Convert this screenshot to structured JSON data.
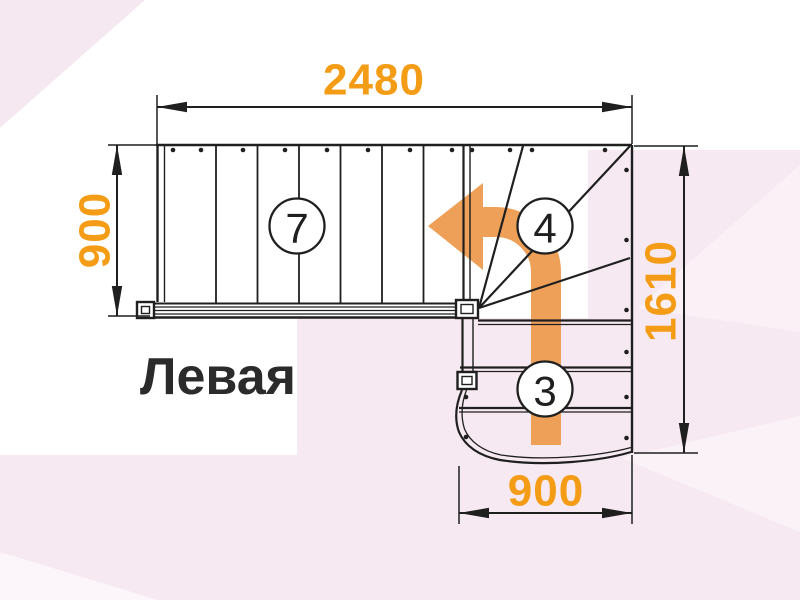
{
  "diagram": {
    "label": "Левая",
    "dimensions": {
      "top": "2480",
      "left": "900",
      "right": "1610",
      "bottom": "900"
    },
    "counts": {
      "main_flight": "7",
      "winder": "4",
      "lower_flight": "3"
    }
  },
  "colors": {
    "dimension_text": "#F49C15",
    "arrow": "#EEA058",
    "line": "#1F1F1F",
    "background_pink": "#F7E9F1",
    "label_text": "#2B2B2B"
  }
}
